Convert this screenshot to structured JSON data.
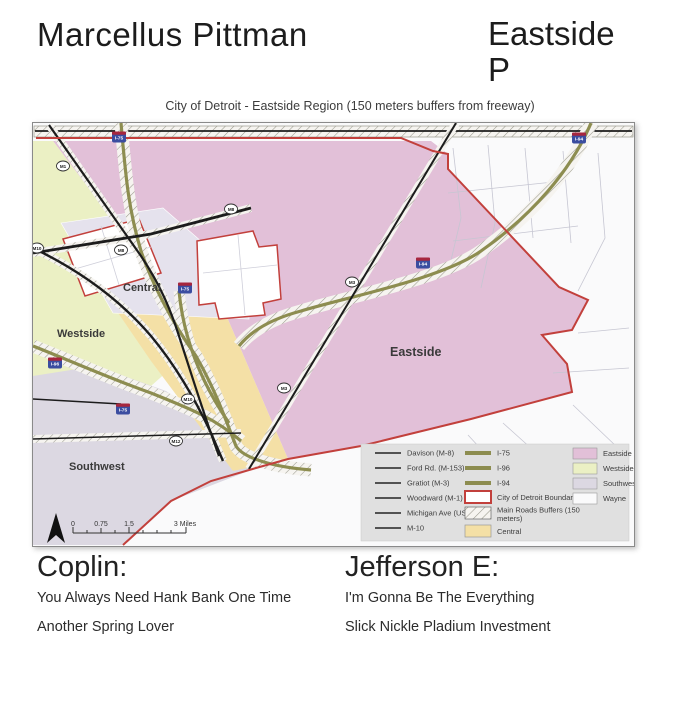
{
  "header": {
    "artist": "Marcellus Pittman",
    "album_line1": "Eastside",
    "album_line2": "P"
  },
  "map": {
    "title": "City of Detroit - Eastside Region (150 meters buffers from freeway)",
    "region_labels": [
      "Westside",
      "Southwest",
      "Central",
      "Eastside"
    ],
    "shields": [
      {
        "label": "I-75"
      },
      {
        "label": "I-94"
      },
      {
        "label": "I-94"
      },
      {
        "label": "I-75"
      },
      {
        "label": "I-96"
      },
      {
        "label": "I-75"
      },
      {
        "label": "M1"
      },
      {
        "label": "M8"
      },
      {
        "label": "M8"
      },
      {
        "label": "M3"
      },
      {
        "label": "M3"
      },
      {
        "label": "M10"
      },
      {
        "label": "M10"
      },
      {
        "label": "M12"
      }
    ],
    "scale_bar": {
      "labels": [
        "0",
        "0.75",
        "1.5",
        "3 Miles"
      ]
    },
    "legend": {
      "roads": [
        "Davison (M-8)",
        "Ford Rd. (M-153)",
        "Gratiot (M-3)",
        "Woodward (M-1)",
        "Michigan Ave (US-12)",
        "M-10"
      ],
      "highways": [
        "I-75",
        "I-96",
        "I-94"
      ],
      "boundary_label": "City of Detroit Boundaries",
      "buffer_label_line1": "Main Roads Buffers (150",
      "buffer_label_line2": "meters)",
      "central_label": "Central",
      "areas": [
        "Eastside",
        "Westside",
        "Southwest",
        "Wayne"
      ]
    },
    "colors": {
      "eastside": "#e2c0d8",
      "westside": "#ebf0c4",
      "southwest": "#dcd8e2",
      "wayne": "#fafafb",
      "central": "#f4e0a6",
      "enclave": "#ffffff",
      "lavender": "#e5e2ed",
      "freeway": "#8d8d50",
      "boundary": "#c2403c",
      "legend_bg": "#e0e0e0"
    }
  },
  "footer": {
    "left": {
      "heading": "Coplin:",
      "lines": [
        "You Always Need Hank Bank One Time",
        "Another Spring Lover"
      ]
    },
    "right": {
      "heading": "Jefferson E:",
      "lines": [
        "I'm Gonna Be The Everything",
        "Slick Nickle Pladium Investment"
      ]
    }
  }
}
